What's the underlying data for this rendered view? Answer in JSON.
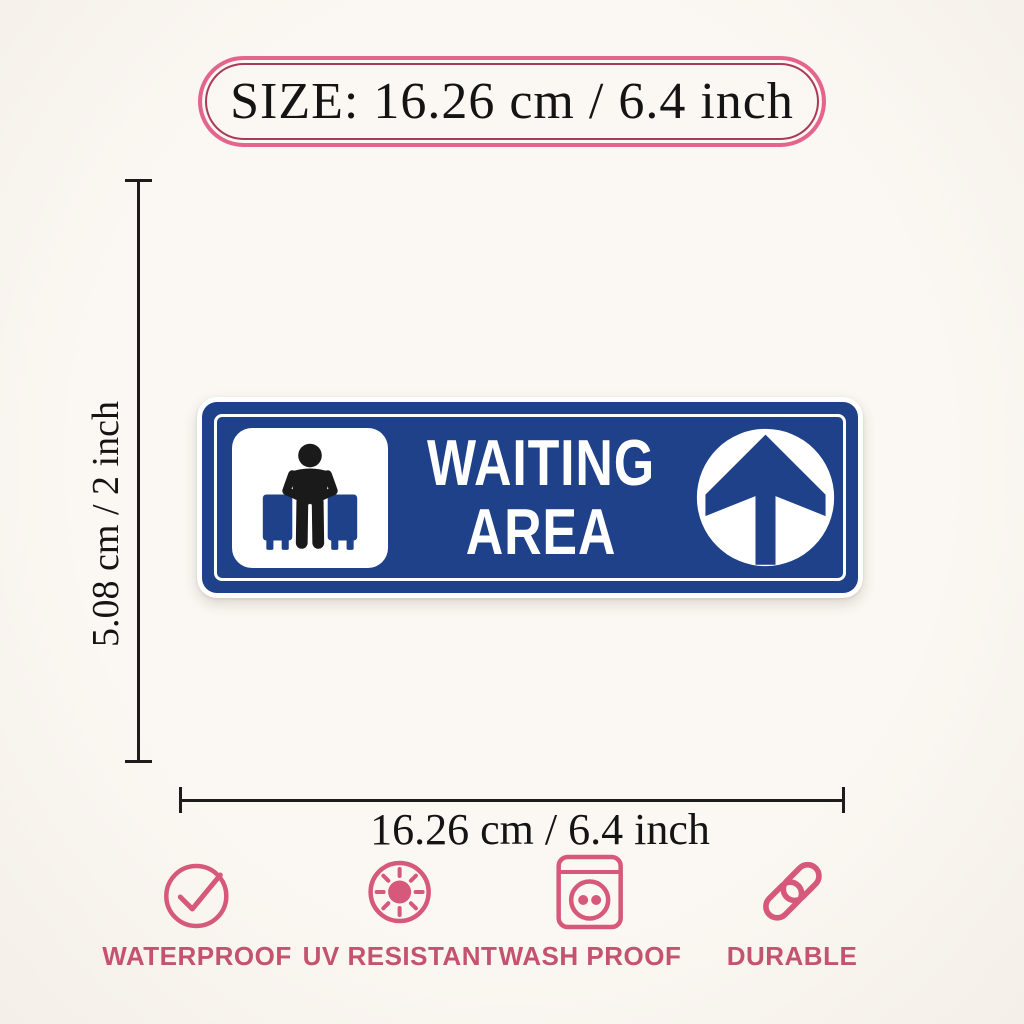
{
  "size_badge": {
    "text": "SIZE: 16.26 cm / 6.4 inch"
  },
  "dimensions": {
    "height_label": "5.08 cm / 2 inch",
    "width_label": "16.26 cm / 6.4 inch"
  },
  "sign": {
    "title_line1": "WAITING",
    "title_line2": "AREA",
    "left_icon": "sitting-person-icon",
    "right_icon": "up-arrow-icon"
  },
  "features": [
    {
      "label": "WATERPROOF",
      "icon": "check-circle-icon"
    },
    {
      "label": "UV RESISTANT",
      "icon": "sun-icon"
    },
    {
      "label": "WASH PROOF",
      "icon": "washing-machine-icon"
    },
    {
      "label": "DURABLE",
      "icon": "chain-link-icon"
    }
  ],
  "colors": {
    "background": "#fbf7f2",
    "sign_blue": "#1e4189",
    "badge_border": "#e4648d",
    "badge_inner_line": "#a93a58",
    "icon_pink": "#d6597c",
    "label_pink": "#c4536f",
    "line_black": "#1c1c1c",
    "text_black": "#141414",
    "white": "#ffffff",
    "pictogram_black": "#1a1a1a"
  }
}
